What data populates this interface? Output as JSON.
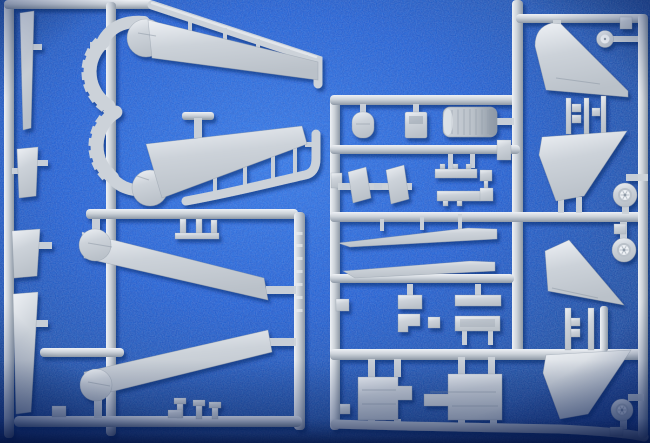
{
  "scene": {
    "type": "photograph",
    "subject": "Light grey injection-moulded model aircraft kit sprues laid on blue felt cloth",
    "background": "royal blue felt with vignetted edges",
    "sprue_count": 2,
    "visible_text": "none (illegible embossed marking on one runner)"
  },
  "colors": {
    "felt-light": "#2f76ec",
    "felt": "#1d5cd6",
    "felt-mid": "#16479f",
    "felt-dark": "#0c2f86",
    "felt-edge": "#051c54",
    "plastic": "#ccd2d9",
    "plastic-light": "#eef1f5",
    "plastic-mid": "#bac1c9",
    "plastic-dark": "#8e99a6",
    "shadow": "#051d5e"
  },
  "left_sprue": {
    "name": "sprue-A",
    "parts": [
      {
        "label": "swing wing upper half with toothed pivot rack"
      },
      {
        "label": "swing wing lower half with toothed pivot rack"
      },
      {
        "label": "outer wing panel upper (round pivot boss)"
      },
      {
        "label": "outer wing panel lower (round pivot boss)"
      },
      {
        "label": "flap / slat strips x4 along left edge"
      },
      {
        "label": "small pins and clips"
      },
      {
        "label": "runner with embossed marking"
      }
    ]
  },
  "right_sprue": {
    "name": "sprue-B",
    "parts": [
      {
        "label": "cockpit oval part"
      },
      {
        "label": "cockpit box part"
      },
      {
        "label": "ribbed jet exhaust nozzle"
      },
      {
        "label": "intake ramp plates x2"
      },
      {
        "label": "pylon bars and clips"
      },
      {
        "label": "leading edge slat strips x2"
      },
      {
        "label": "equipment trays and clips"
      },
      {
        "label": "undercarriage bay blocks x2"
      },
      {
        "label": "vertical tail fin upper right"
      },
      {
        "label": "tailplane panels x2"
      },
      {
        "label": "vertical tail fin lower right"
      },
      {
        "label": "road wheels x4"
      },
      {
        "label": "connector pins"
      }
    ]
  }
}
